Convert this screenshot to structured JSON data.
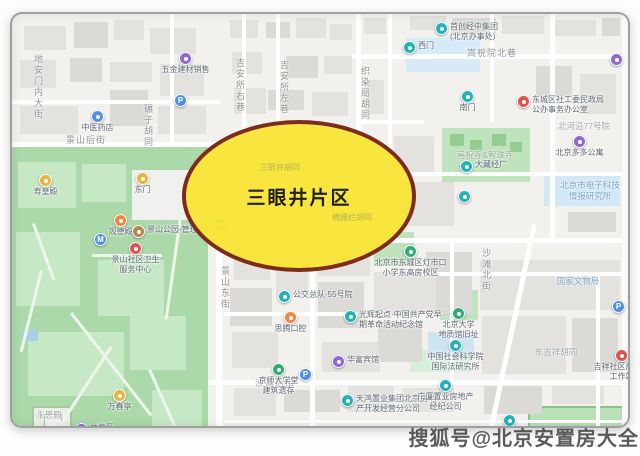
{
  "highlight": {
    "label": "三眼井片区"
  },
  "watermark": {
    "text": "搜狐号@北京安置房大全"
  },
  "colors": {
    "highlight_fill": "#F8E537",
    "highlight_border": "#7D2C1C",
    "park_green": "#ABD9A9",
    "road_white": "#FFFFFF",
    "land": "#F2F1EE"
  },
  "streets": [
    {
      "label": "地安门内大街"
    },
    {
      "label": "景山后街"
    },
    {
      "label": "吉安所右巷"
    },
    {
      "label": "吉安所左巷"
    },
    {
      "label": "碾子胡同"
    },
    {
      "label": "织染局胡同"
    },
    {
      "label": "嵩祝院北巷"
    },
    {
      "label": "景山东街"
    },
    {
      "label": "北河沿大街"
    },
    {
      "label": "沙滩北街"
    },
    {
      "label": "沙滩后街"
    }
  ],
  "areas": [
    {
      "label": "国家文物局"
    },
    {
      "label": "北京市电子科技\n情报研究所"
    },
    {
      "label": "嵩祝寺&智珠寺"
    },
    {
      "label": "北河沿77号院"
    },
    {
      "label": "东吉祥胡同"
    },
    {
      "label": "永思殿"
    }
  ],
  "ghosts": [
    {
      "label": "三眼井胡同"
    },
    {
      "label": "横栅栏胡同"
    }
  ],
  "pois": [
    {
      "label": "五金建材销售",
      "glyph": ""
    },
    {
      "label": "",
      "glyph": "P"
    },
    {
      "label": "中医药店",
      "glyph": ""
    },
    {
      "label": "寿皇殿",
      "glyph": ""
    },
    {
      "label": "东门",
      "glyph": ""
    },
    {
      "label": "观德殿",
      "glyph": ""
    },
    {
      "label": "景山公园-管理处",
      "glyph": ""
    },
    {
      "label": "景山社区卫生\n服务中心",
      "glyph": ""
    },
    {
      "label": "",
      "glyph": "M"
    },
    {
      "label": "万春亭",
      "glyph": ""
    },
    {
      "label": "休息区",
      "glyph": ""
    },
    {
      "label": "",
      "glyph": ""
    },
    {
      "label": "",
      "glyph": ""
    },
    {
      "label": "",
      "glyph": ""
    },
    {
      "label": "公交总队·55号院",
      "glyph": ""
    },
    {
      "label": "思腾口腔",
      "glyph": ""
    },
    {
      "label": "光辉起点·中国共产党早\n期革命活动纪念馆",
      "glyph": ""
    },
    {
      "label": "北京市东城区灯市口\n小学东高房校区",
      "glyph": ""
    },
    {
      "label": "京师大学堂\n建筑遗存",
      "glyph": ""
    },
    {
      "label": "",
      "glyph": "P"
    },
    {
      "label": "华富宾馆",
      "glyph": ""
    },
    {
      "label": "天鸿置业集团北京房地\n产开发经营分公司",
      "glyph": ""
    },
    {
      "label": "广厦置业房地产\n经纪公司",
      "glyph": ""
    },
    {
      "label": "沙滩北街\n乙2号院",
      "glyph": ""
    },
    {
      "label": "北京大学\n地质馆旧址",
      "glyph": ""
    },
    {
      "label": "中国社会科学院\n国际法研究所",
      "glyph": ""
    },
    {
      "label": "",
      "glyph": "P"
    },
    {
      "label": "吉祥社区居委会\n工作站",
      "glyph": ""
    },
    {
      "label": "北京多多公寓",
      "glyph": ""
    },
    {
      "label": "东城区社工委民政局\n公办事务办公室",
      "glyph": ""
    },
    {
      "label": "首创经中集团\n(北京办事处)",
      "glyph": ""
    },
    {
      "label": "西门",
      "glyph": ""
    },
    {
      "label": "南门",
      "glyph": ""
    },
    {
      "label": "大藏经厂",
      "glyph": ""
    },
    {
      "label": "",
      "glyph": ""
    },
    {
      "label": "",
      "glyph": ""
    }
  ]
}
